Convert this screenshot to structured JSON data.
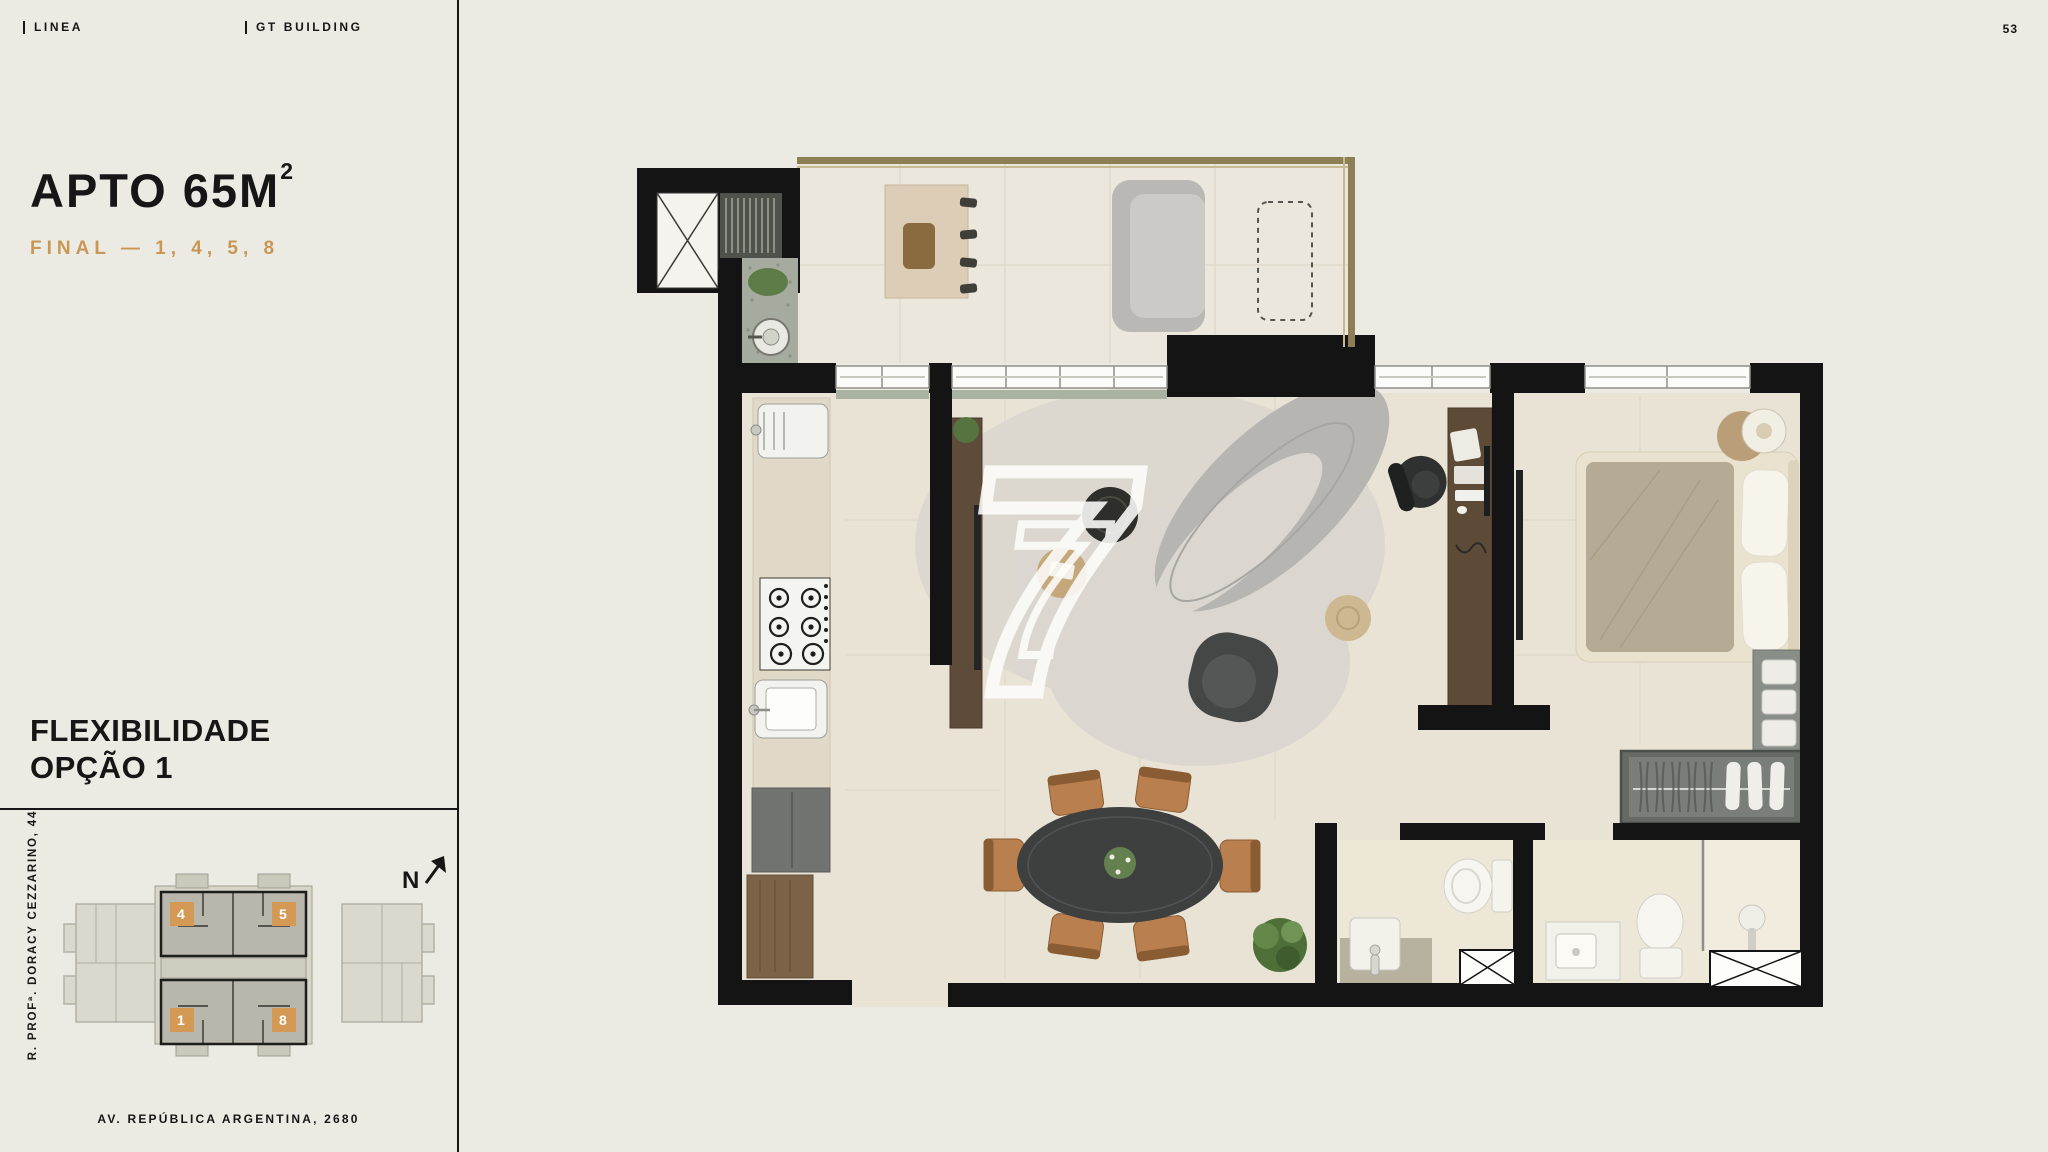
{
  "header": {
    "brand": "LINEA",
    "building": "GT BUILDING",
    "page_number": "53"
  },
  "sidebar": {
    "apartment_title": "APTO 65M",
    "apartment_title_sup": "2",
    "apartment_subtitle": "FINAL — 1, 4, 5, 8",
    "flexibility_line1": "FLEXIBILIDADE",
    "flexibility_line2": "OPÇÃO 1",
    "keyplan": {
      "units": {
        "top_left": "4",
        "top_right": "5",
        "bottom_left": "1",
        "bottom_right": "8"
      },
      "north_label": "N"
    },
    "street_side": "R. PROFª. DORACY CEZZARINO, 44",
    "street_bottom": "AV. REPÚBLICA ARGENTINA, 2680"
  },
  "floorplan": {
    "watermark": "7"
  },
  "colors": {
    "background": "#ECEBE3",
    "ink": "#161616",
    "accent_orange": "#C89756",
    "wall_black": "#141414",
    "floor_beige": "#E9E3D5",
    "railing_bronze": "#8C7F55"
  }
}
